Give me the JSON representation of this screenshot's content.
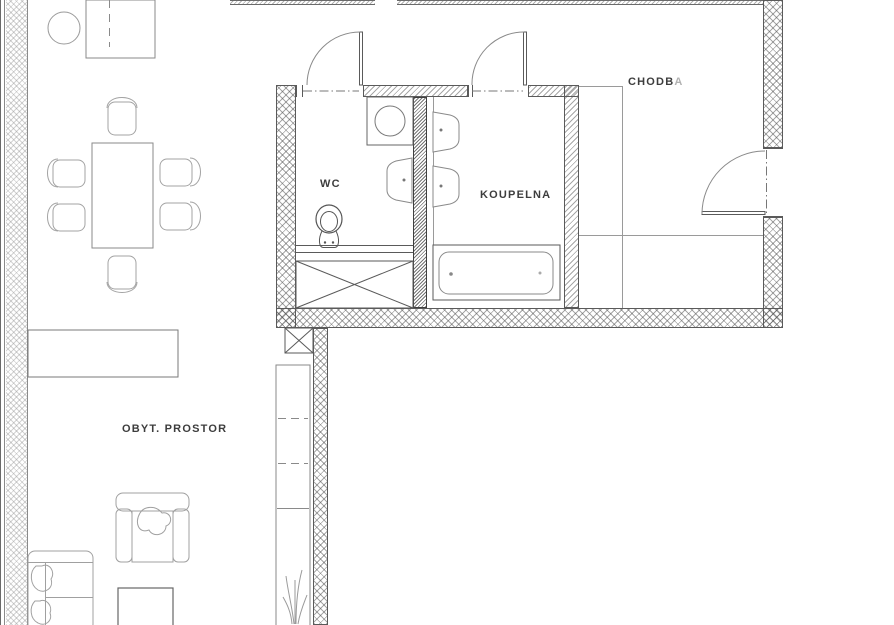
{
  "drawing": {
    "kind": "apartment floor plan",
    "labels": {
      "wc": "WC",
      "koupelna": "KOUPELNA",
      "chodba_main": "CHODB",
      "chodba_suffix": "A",
      "living": "OBYT. PROSTOR"
    },
    "colors": {
      "background": "#ffffff",
      "wall_line": "#5a5a5a",
      "wall_hatch": "#8a8a8a",
      "furniture_line": "#9a9a9a",
      "fixture_line": "#777777",
      "text": "#3d3d3d",
      "text_faded": "#b2b2b2"
    },
    "rooms": [
      {
        "name": "wc",
        "fixtures": [
          "washing-machine",
          "sink",
          "toilet",
          "installation-shaft"
        ]
      },
      {
        "name": "koupelna",
        "fixtures": [
          "sink",
          "sink",
          "bathtub"
        ]
      },
      {
        "name": "chodba",
        "fixtures": [
          "entry-door"
        ]
      },
      {
        "name": "obytny-prostor",
        "fixtures": [
          "wardrobe",
          "round-chair",
          "dining-table",
          "chairs",
          "sideboard",
          "armchair",
          "sofa",
          "coffee-table",
          "kitchen-cabinet",
          "plant"
        ]
      }
    ]
  }
}
